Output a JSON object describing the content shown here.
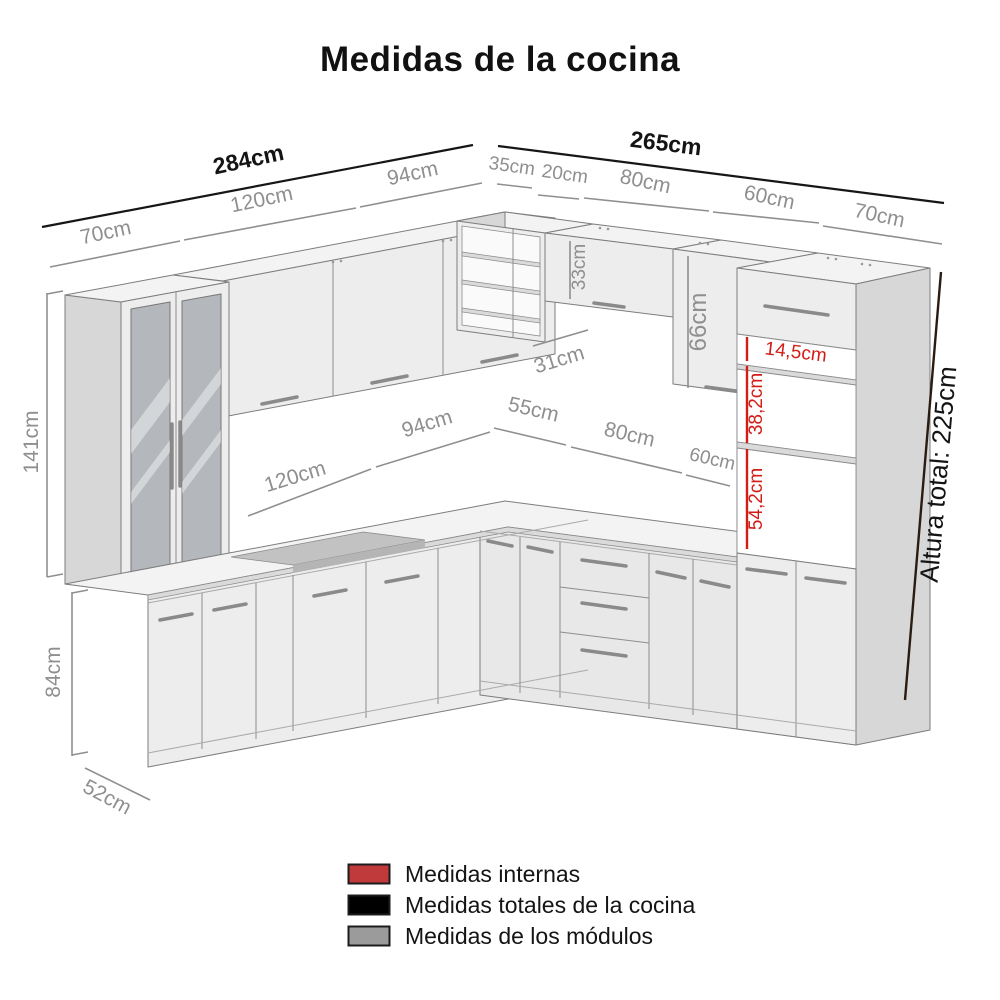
{
  "title": "Medidas de la cocina",
  "colors": {
    "internal_red": "#c0393b",
    "total_black": "#000000",
    "module_gray": "#9b9b9b",
    "dim_gray_text": "#8f8f8f",
    "dim_red_line": "#d21c15",
    "height_line_dark": "#2b1c12",
    "cabinet_light": "#ededed",
    "glass_gray": "#b4b8bc"
  },
  "dimensions": {
    "top_left": {
      "total": "284cm",
      "segments": [
        "70cm",
        "120cm",
        "94cm"
      ]
    },
    "top_right": {
      "total": "265cm",
      "segments": [
        "35cm",
        "20cm",
        "80cm",
        "60cm",
        "70cm"
      ]
    },
    "left": {
      "upper_height": "141cm",
      "base_height": "84cm",
      "base_depth": "52cm"
    },
    "counter": [
      "120cm",
      "94cm",
      "55cm",
      "80cm",
      "60cm"
    ],
    "wall_units": {
      "flip_cabinet_height": "33cm",
      "upper_cabinet_height": "66cm",
      "upper_cabinet_depth": "31cm"
    },
    "internal": [
      "14,5cm",
      "38,2cm",
      "54,2cm"
    ],
    "total_height": "Altura total: 225cm"
  },
  "legend": [
    {
      "label": "Medidas internas",
      "color": "#c0393b"
    },
    {
      "label": "Medidas totales de la cocina",
      "color": "#000000"
    },
    {
      "label": "Medidas de los módulos",
      "color": "#9b9b9b"
    }
  ]
}
